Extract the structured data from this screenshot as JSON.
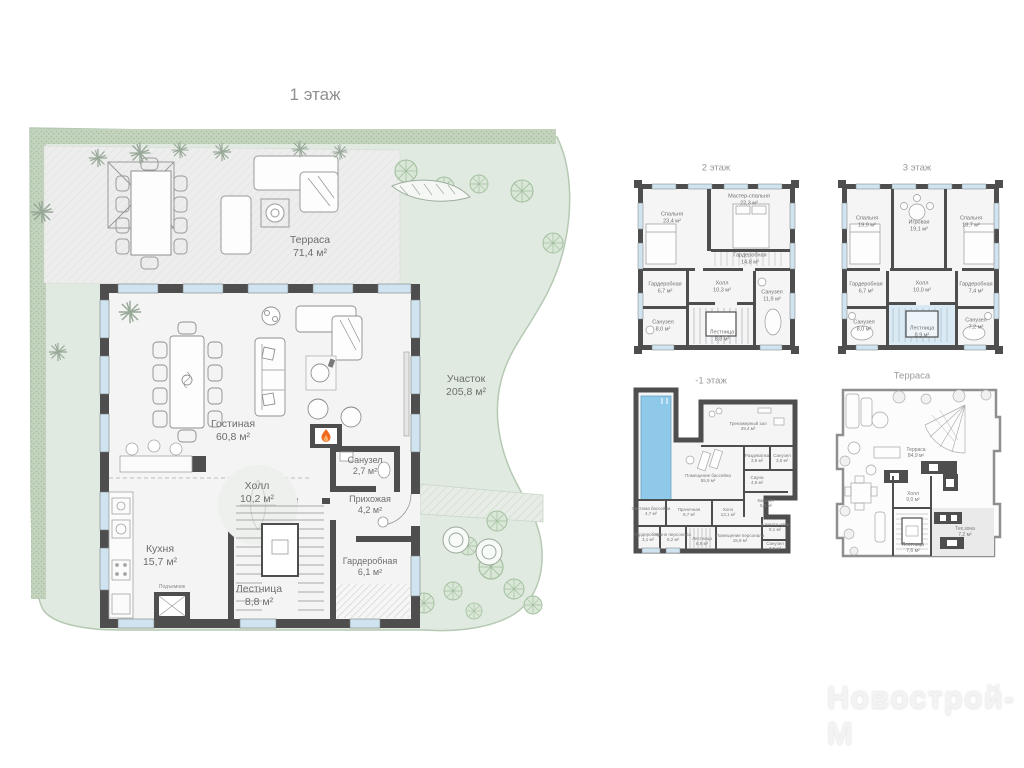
{
  "watermark": "Новострой-М",
  "floor1": {
    "title": "1 этаж",
    "rooms": {
      "terrace": {
        "name": "Терраса",
        "area": "71,4 м²"
      },
      "plot": {
        "name": "Участок",
        "area": "205,8 м²"
      },
      "living": {
        "name": "Гостиная",
        "area": "60,8 м²"
      },
      "bath": {
        "name": "Санузел",
        "area": "2,7 м²"
      },
      "hall": {
        "name": "Холл",
        "area": "10,2 м²"
      },
      "entry": {
        "name": "Прихожая",
        "area": "4,2 м²"
      },
      "kitchen": {
        "name": "Кухня",
        "area": "15,7 м²"
      },
      "lift": {
        "name": "Подъемник",
        "area": ""
      },
      "stairs": {
        "name": "Лестница",
        "area": "8,8 м²"
      },
      "wardrobe": {
        "name": "Гардеробная",
        "area": "6,1 м²"
      }
    }
  },
  "floor2": {
    "title": "2 этаж",
    "rooms": {
      "bedroom": {
        "name": "Спальня",
        "area": "23,4 м²"
      },
      "master": {
        "name": "Мастер-спальня",
        "area": "22,3 м²"
      },
      "wardrobe_big": {
        "name": "Гардеробная",
        "area": "14,8 м²"
      },
      "wardrobe_small": {
        "name": "Гардеробная",
        "area": "6,7 м²"
      },
      "hall": {
        "name": "Холл",
        "area": "10,3 м²"
      },
      "bath_big": {
        "name": "Санузел",
        "area": "11,9 м²"
      },
      "bath_small": {
        "name": "Санузел",
        "area": "8,0 м²"
      },
      "stairs": {
        "name": "Лестница",
        "area": "8,8 м²"
      }
    }
  },
  "floor3": {
    "title": "3 этаж",
    "rooms": {
      "bedroom_left": {
        "name": "Спальня",
        "area": "19,9 м²"
      },
      "playroom": {
        "name": "Игровая",
        "area": "19,1 м²"
      },
      "bedroom_right": {
        "name": "Спальня",
        "area": "18,7 м²"
      },
      "wardrobe_left": {
        "name": "Гардеробная",
        "area": "6,7 м²"
      },
      "hall": {
        "name": "Холл",
        "area": "10,0 м²"
      },
      "wardrobe_right": {
        "name": "Гардеробная",
        "area": "7,4 м²"
      },
      "bath_left": {
        "name": "Санузел",
        "area": "8,0 м²"
      },
      "stairs": {
        "name": "Лестница",
        "area": "8,9 м²"
      },
      "bath_right": {
        "name": "Санузел",
        "area": "7,2 м²"
      }
    }
  },
  "basement": {
    "title": "-1 этаж",
    "rooms": {
      "gym": {
        "name": "Тренажерный зал",
        "area": "29,4 м²"
      },
      "changing": {
        "name": "Раздевалка",
        "area": "3,9 м²"
      },
      "bath_top": {
        "name": "Санузел",
        "area": "3,6 м²"
      },
      "pool_room": {
        "name": "Помещение бассейна",
        "area": "55,9 м²"
      },
      "sauna": {
        "name": "Сауна",
        "area": "4,9 м²"
      },
      "office": {
        "name": "Кабинет",
        "area": "5,0 м²"
      },
      "pool_system": {
        "name": "Система бассейна",
        "area": "4,7 м²"
      },
      "laundry": {
        "name": "Прачечная",
        "area": "9,7 м²"
      },
      "hall": {
        "name": "Холл",
        "area": "13,1 м²"
      },
      "wardrobe": {
        "name": "Гардеробная",
        "area": "3,1 м²"
      },
      "staff_kitchen": {
        "name": "Кухня персонала",
        "area": "8,2 м²"
      },
      "stairs": {
        "name": "Лестница",
        "area": "8,9 м²"
      },
      "staff_room": {
        "name": "Помещение персонала",
        "area": "15,9 м²"
      },
      "nanny": {
        "name": "Комната няни",
        "area": "9,1 м²"
      },
      "bath_bottom": {
        "name": "Санузел",
        "area": "3,6 м²"
      }
    }
  },
  "roof": {
    "title": "Терраса",
    "rooms": {
      "terrace": {
        "name": "Терраса",
        "area": "84,9 м²"
      },
      "hall": {
        "name": "Холл",
        "area": "9,0 м²"
      },
      "stairs": {
        "name": "Лестница",
        "area": "7,6 м²"
      },
      "tech": {
        "name": "Тех.зона",
        "area": "7,2 м²"
      }
    }
  }
}
